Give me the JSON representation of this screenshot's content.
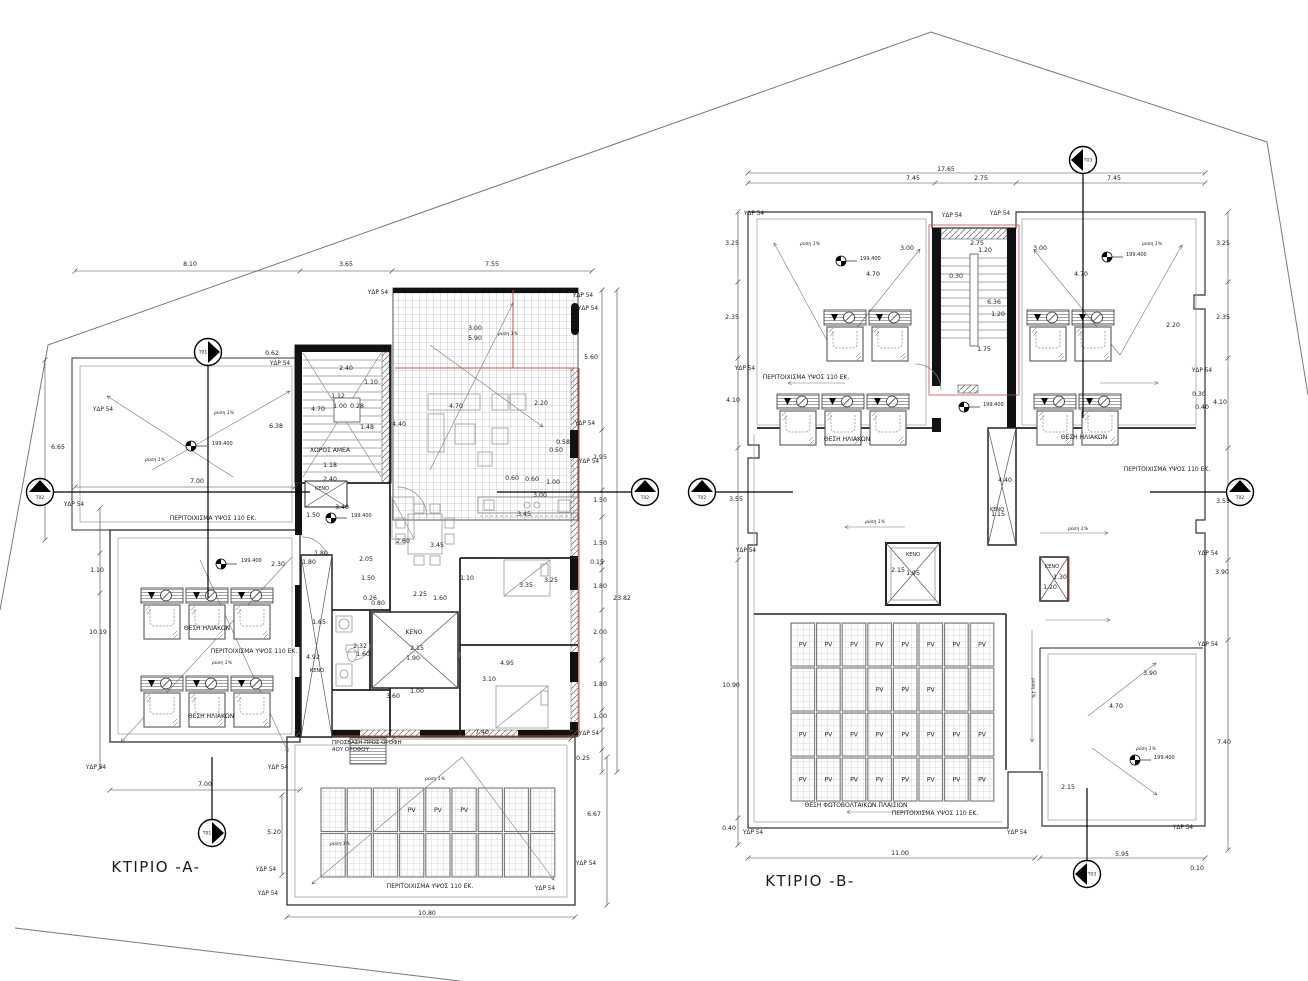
{
  "titles": {
    "building_a": "ΚΤΙΡΙΟ -A-",
    "building_b": "ΚΤΙΡΙΟ -B-",
    "a_pos": [
      156,
      868
    ],
    "b_pos": [
      810,
      882
    ]
  },
  "colors": {
    "accent_red": "#c0504d",
    "line": "#1a1a1a"
  },
  "labels": {
    "dims": [
      [
        "8.10",
        190,
        266
      ],
      [
        "3.65",
        346,
        266
      ],
      [
        "7.55",
        492,
        266
      ],
      [
        "0.62",
        272,
        355
      ],
      [
        "6.65",
        58,
        449
      ],
      [
        "6.38",
        276,
        428
      ],
      [
        "4.70",
        318,
        411
      ],
      [
        "2.40",
        346,
        370
      ],
      [
        "1.12",
        338,
        398
      ],
      [
        "1.00",
        340,
        408
      ],
      [
        "0.28",
        357,
        408
      ],
      [
        "1.10",
        371,
        384
      ],
      [
        "1.48",
        367,
        429
      ],
      [
        "4.40",
        399,
        426
      ],
      [
        "4.70",
        456,
        408
      ],
      [
        "2.20",
        541,
        405
      ],
      [
        "3.00",
        475,
        330
      ],
      [
        "5.90",
        475,
        340
      ],
      [
        "1.18",
        330,
        467
      ],
      [
        "2.40",
        330,
        481
      ],
      [
        "7.00",
        197,
        483
      ],
      [
        "3.40",
        342,
        509
      ],
      [
        "1.50",
        313,
        517
      ],
      [
        "1.80",
        321,
        555
      ],
      [
        "1.80",
        309,
        564
      ],
      [
        "2.05",
        366,
        561
      ],
      [
        "1.50",
        368,
        580
      ],
      [
        "2.30",
        278,
        566
      ],
      [
        "2.60",
        403,
        543
      ],
      [
        "3.45",
        437,
        547
      ],
      [
        "3.45",
        524,
        516
      ],
      [
        "0.26",
        370,
        600
      ],
      [
        "0.80",
        378,
        605
      ],
      [
        "2.25",
        420,
        596
      ],
      [
        "1.60",
        440,
        600
      ],
      [
        "1.10",
        467,
        580
      ],
      [
        "3.35",
        526,
        587
      ],
      [
        "3.25",
        551,
        582
      ],
      [
        "0.60",
        512,
        480
      ],
      [
        "0.60",
        532,
        481
      ],
      [
        "1.00",
        553,
        484
      ],
      [
        "3.00",
        540,
        497
      ],
      [
        "0.58",
        563,
        444
      ],
      [
        "0.50",
        556,
        452
      ],
      [
        "1.65",
        319,
        624
      ],
      [
        "4.92",
        313,
        659
      ],
      [
        "2.32",
        360,
        648
      ],
      [
        "1.60",
        363,
        656
      ],
      [
        "2.15",
        417,
        650
      ],
      [
        "1.90",
        413,
        660
      ],
      [
        "4.95",
        507,
        665
      ],
      [
        "3.10",
        489,
        681
      ],
      [
        "1.00",
        417,
        693
      ],
      [
        "3.60",
        393,
        698
      ],
      [
        "7.40",
        482,
        734
      ],
      [
        "0.25",
        583,
        760
      ],
      [
        "6.67",
        594,
        816
      ],
      [
        "10.80",
        427,
        915
      ],
      [
        "10.19",
        98,
        634
      ],
      [
        "1.10",
        97,
        572
      ],
      [
        "7.00",
        205,
        786
      ],
      [
        "5.20",
        274,
        834
      ],
      [
        "5.60",
        591,
        359
      ],
      [
        "1.95",
        600,
        459
      ],
      [
        "1.50",
        600,
        502
      ],
      [
        "1.50",
        600,
        545
      ],
      [
        "0.15",
        597,
        564
      ],
      [
        "1.80",
        600,
        588
      ],
      [
        "2.00",
        600,
        634
      ],
      [
        "1.80",
        600,
        686
      ],
      [
        "1.00",
        600,
        718
      ],
      [
        "23.82",
        622,
        600
      ],
      [
        "17.65",
        946,
        171
      ],
      [
        "7.45",
        913,
        180
      ],
      [
        "2.75",
        981,
        180
      ],
      [
        "7.45",
        1114,
        180
      ],
      [
        "3.25",
        732,
        245
      ],
      [
        "3.25",
        1223,
        245
      ],
      [
        "3.00",
        907,
        250
      ],
      [
        "3.00",
        1040,
        250
      ],
      [
        "2.75",
        977,
        245
      ],
      [
        "1.20",
        985,
        252
      ],
      [
        "0.30",
        956,
        278
      ],
      [
        "4.70",
        873,
        276
      ],
      [
        "4.70",
        1081,
        276
      ],
      [
        "6.36",
        994,
        304
      ],
      [
        "1.20",
        998,
        316
      ],
      [
        "2.20",
        1173,
        327
      ],
      [
        "1.75",
        984,
        351
      ],
      [
        "2.35",
        732,
        319
      ],
      [
        "2.35",
        1223,
        319
      ],
      [
        "4.10",
        733,
        402
      ],
      [
        "4.10",
        1220,
        404
      ],
      [
        "0.30",
        1199,
        396
      ],
      [
        "0.40",
        1202,
        409
      ],
      [
        "3.55",
        736,
        501
      ],
      [
        "3.55",
        1223,
        503
      ],
      [
        "3.90",
        1222,
        574
      ],
      [
        "10.90",
        731,
        687
      ],
      [
        "0.40",
        729,
        830
      ],
      [
        "7.40",
        1224,
        744
      ],
      [
        "3.90",
        1150,
        675
      ],
      [
        "4.70",
        1116,
        708
      ],
      [
        "2.15",
        1068,
        789
      ],
      [
        "2.15",
        898,
        572
      ],
      [
        "1.95",
        913,
        575
      ],
      [
        "4.40",
        1005,
        482
      ],
      [
        "1.15",
        998,
        516
      ],
      [
        "1.30",
        1060,
        579
      ],
      [
        "1.20",
        1050,
        589
      ],
      [
        "11.00",
        900,
        855
      ],
      [
        "5.95",
        1122,
        856
      ],
      [
        "0.10",
        1197,
        870
      ]
    ],
    "ydr": {
      "text": "ΥΔΡ 54",
      "points": [
        [
          103,
          411
        ],
        [
          74,
          506
        ],
        [
          280,
          365
        ],
        [
          378,
          294
        ],
        [
          583,
          297
        ],
        [
          588,
          310
        ],
        [
          585,
          425
        ],
        [
          589,
          463
        ],
        [
          96,
          769
        ],
        [
          278,
          769
        ],
        [
          589,
          735
        ],
        [
          586,
          865
        ],
        [
          545,
          890
        ],
        [
          266,
          871
        ],
        [
          268,
          895
        ],
        [
          754,
          215
        ],
        [
          952,
          217
        ],
        [
          1000,
          215
        ],
        [
          745,
          370
        ],
        [
          1202,
          372
        ],
        [
          746,
          552
        ],
        [
          1208,
          555
        ],
        [
          1208,
          646
        ],
        [
          1183,
          829
        ],
        [
          753,
          834
        ],
        [
          1017,
          834
        ]
      ]
    },
    "names": [
      [
        "ΧΩΡΟΣ ΑΜΕΑ",
        330,
        452,
        6
      ],
      [
        "ΚΕΝΟ",
        322,
        490,
        5
      ],
      [
        "ΚΕΝΟ",
        317,
        672,
        5
      ],
      [
        "ΚΕΝΟ",
        414,
        634,
        6
      ],
      [
        "ΘΕΣΗ ΗΛΙΑΚΩΝ",
        207,
        630,
        6
      ],
      [
        "ΘΕΣΗ ΗΛΙΑΚΩΝ",
        211,
        718,
        6
      ],
      [
        "ΠΕΡΙΤΟΙΧΙΣΜΑ ΥΨΟΣ 110 ΕΚ.",
        213,
        520,
        6
      ],
      [
        "ΠΕΡΙΤΟΙΧΙΣΜΑ ΥΨΟΣ 110 ΕΚ.",
        254,
        653,
        6
      ],
      [
        "ΠΕΡΙΤΟΙΧΙΣΜΑ ΥΨΟΣ 110 ΕΚ.",
        430,
        888,
        6
      ],
      [
        "ΠΡΟΣΒΑΣΗ ΠΡΟΣ ΟΡΟΦΗ",
        332,
        744,
        5.5,
        "start"
      ],
      [
        "4ΟΥ ΟΡΟΦΟΥ",
        332,
        751,
        5.5,
        "start"
      ],
      [
        "ΘΕΣΗ ΗΛΙΑΚΩΝ",
        847,
        441,
        6
      ],
      [
        "ΘΕΣΗ ΗΛΙΑΚΩΝ",
        1084,
        439,
        6
      ],
      [
        "ΠΕΡΙΤΟΙΧΙΣΜΑ ΥΨΟΣ 110 ΕΚ.",
        806,
        379,
        6
      ],
      [
        "ΠΕΡΙΤΟΙΧΙΣΜΑ ΥΨΟΣ 110 ΕΚ.",
        1167,
        471,
        6
      ],
      [
        "ΠΕΡΙΤΟΙΧΙΣΜΑ ΥΨΟΣ 110 ΕΚ.",
        935,
        815,
        6
      ],
      [
        "ΘΕΣΗ ΦΩΤΟΒΟΛΤΑΙΚΩΝ ΠΛΑΙΣΙΩΝ",
        856,
        807,
        6
      ],
      [
        "ΚΕΝΟ",
        997,
        511,
        5
      ],
      [
        "ΚΕΝΟ",
        1052,
        568,
        5
      ],
      [
        "ΚΕΝΟ",
        913,
        556,
        5
      ]
    ],
    "slope": {
      "text": "ρύση 1%",
      "points": [
        [
          508,
          335,
          0
        ],
        [
          224,
          414,
          0
        ],
        [
          155,
          461,
          0
        ],
        [
          222,
          664,
          0
        ],
        [
          435,
          780,
          0
        ],
        [
          340,
          845,
          0
        ],
        [
          810,
          245,
          0
        ],
        [
          1152,
          245,
          0
        ],
        [
          875,
          523,
          0
        ],
        [
          1078,
          530,
          0
        ],
        [
          1146,
          750,
          0
        ],
        [
          1032,
          688,
          90
        ]
      ]
    },
    "elevation": {
      "text": "199.400",
      "points": [
        [
          212,
          445
        ],
        [
          351,
          517
        ],
        [
          241,
          562
        ],
        [
          860,
          260
        ],
        [
          1126,
          256
        ],
        [
          983,
          406
        ],
        [
          1154,
          759
        ]
      ]
    }
  },
  "benchmarks": [
    [
      191,
      446
    ],
    [
      331,
      518
    ],
    [
      221,
      564
    ],
    [
      841,
      261
    ],
    [
      1107,
      257
    ],
    [
      964,
      407
    ],
    [
      1135,
      760
    ]
  ],
  "markers": [
    {
      "label": "Τ01",
      "x": 208,
      "y": 352,
      "dir": "right",
      "line": [
        208,
        366,
        208,
        598
      ]
    },
    {
      "label": "Τ01",
      "x": 212,
      "y": 833,
      "dir": "right",
      "line": [
        212,
        819,
        212,
        757
      ]
    },
    {
      "label": "Τ02",
      "x": 40,
      "y": 492,
      "dir": "up",
      "line": [
        54,
        492,
        310,
        492
      ]
    },
    {
      "label": "Τ02",
      "x": 645,
      "y": 492,
      "dir": "up",
      "line": [
        631,
        492,
        497,
        492
      ]
    },
    {
      "label": "Τ02",
      "x": 702,
      "y": 492,
      "dir": "up",
      "line": [
        716,
        492,
        793,
        492
      ]
    },
    {
      "label": "Τ02",
      "x": 1240,
      "y": 492,
      "dir": "up",
      "line": [
        1226,
        492,
        1150,
        492
      ]
    },
    {
      "label": "Τ03",
      "x": 1083,
      "y": 160,
      "dir": "left",
      "line": [
        1083,
        174,
        1083,
        418
      ]
    },
    {
      "label": "Τ03",
      "x": 1087,
      "y": 874,
      "dir": "left",
      "line": [
        1087,
        860,
        1087,
        788
      ]
    }
  ],
  "pv": {
    "label": "PV",
    "grids": [
      {
        "x": 320,
        "y": 787,
        "cols": 9,
        "rows": 2,
        "cw": 26.2,
        "ch": 45.5,
        "labels": [
          [
            0,
            3
          ],
          [
            0,
            4
          ],
          [
            0,
            5
          ]
        ]
      },
      {
        "x": 790,
        "y": 622,
        "cols": 8,
        "rows": 4,
        "cw": 25.6,
        "ch": 45,
        "labels": [
          [
            0,
            0
          ],
          [
            0,
            1
          ],
          [
            0,
            2
          ],
          [
            0,
            3
          ],
          [
            0,
            4
          ],
          [
            0,
            5
          ],
          [
            0,
            6
          ],
          [
            0,
            7
          ],
          [
            1,
            3
          ],
          [
            1,
            4
          ],
          [
            1,
            5
          ],
          [
            2,
            0
          ],
          [
            2,
            1
          ],
          [
            2,
            2
          ],
          [
            2,
            3
          ],
          [
            2,
            4
          ],
          [
            2,
            5
          ],
          [
            2,
            6
          ],
          [
            2,
            7
          ],
          [
            3,
            0
          ],
          [
            3,
            1
          ],
          [
            3,
            2
          ],
          [
            3,
            3
          ],
          [
            3,
            4
          ],
          [
            3,
            5
          ],
          [
            3,
            6
          ],
          [
            3,
            7
          ]
        ]
      }
    ]
  },
  "heaters": [
    [
      141,
      588
    ],
    [
      186,
      588
    ],
    [
      231,
      588
    ],
    [
      141,
      676
    ],
    [
      186,
      676
    ],
    [
      231,
      676
    ],
    [
      824,
      310
    ],
    [
      869,
      310
    ],
    [
      1027,
      310
    ],
    [
      1072,
      310
    ],
    [
      777,
      394
    ],
    [
      822,
      394
    ],
    [
      867,
      394
    ],
    [
      1034,
      394
    ],
    [
      1079,
      394
    ]
  ]
}
